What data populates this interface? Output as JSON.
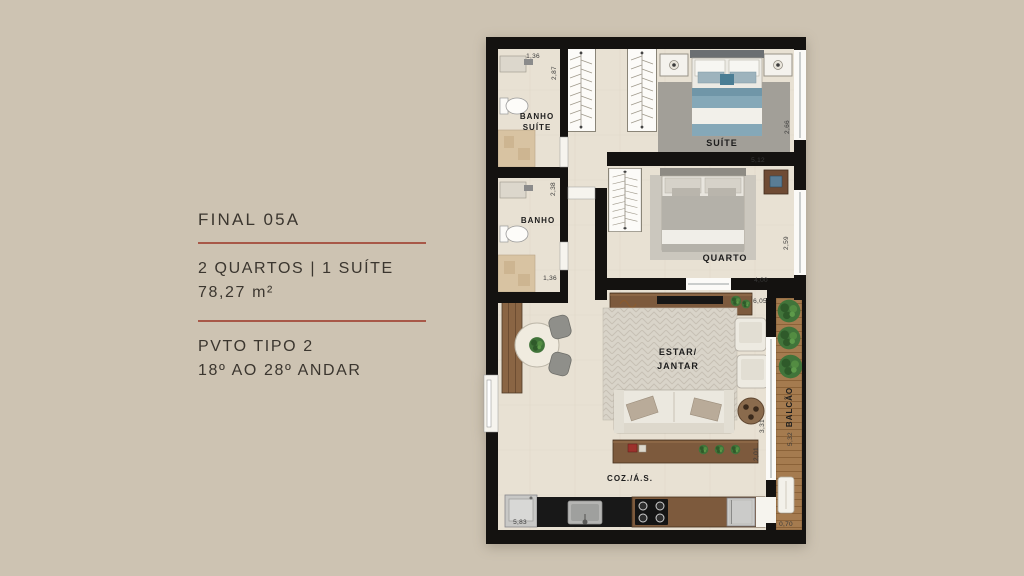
{
  "info_panel": {
    "title": "FINAL 05A",
    "rooms": "2 QUARTOS | 1 SUÍTE",
    "area": "78,27 m²",
    "pavement": "PVTO TIPO 2",
    "floors": "18º AO 28º ANDAR"
  },
  "floor_plan": {
    "labels": {
      "banho_suite_1": "BANHO",
      "banho_suite_2": "SUÍTE",
      "suite": "SUÍTE",
      "banho": "BANHO",
      "quarto": "QUARTO",
      "estar_1": "ESTAR/",
      "estar_2": "JANTAR",
      "cozinha": "COZ./Á.S.",
      "balcao": "BALCÃO"
    },
    "dims": {
      "bs_w": "1,36",
      "bs_h": "2,87",
      "banho_h": "2,38",
      "banho_w": "1,36",
      "suite_h": "2,66",
      "suite_w": "5,12",
      "quarto_h": "2,59",
      "quarto_w": "4,00",
      "estar_w": "6,05",
      "estar_h_upper": "3,31",
      "estar_h_lower": "2,01",
      "coz_w": "5,83",
      "balcao_h": "5,32",
      "balcao_w": "0,70"
    }
  },
  "colors": {
    "page_background": "#cdc3b2",
    "plan_floor": "#e8e1d3",
    "walls": "#141210",
    "divider_line": "#a85848",
    "wood": "#7d5a3d",
    "deck_wood": "#a57b4f",
    "suite_bed_blue": "#85a8b8",
    "plant_green": "#41743a",
    "text": "#3b362f"
  }
}
